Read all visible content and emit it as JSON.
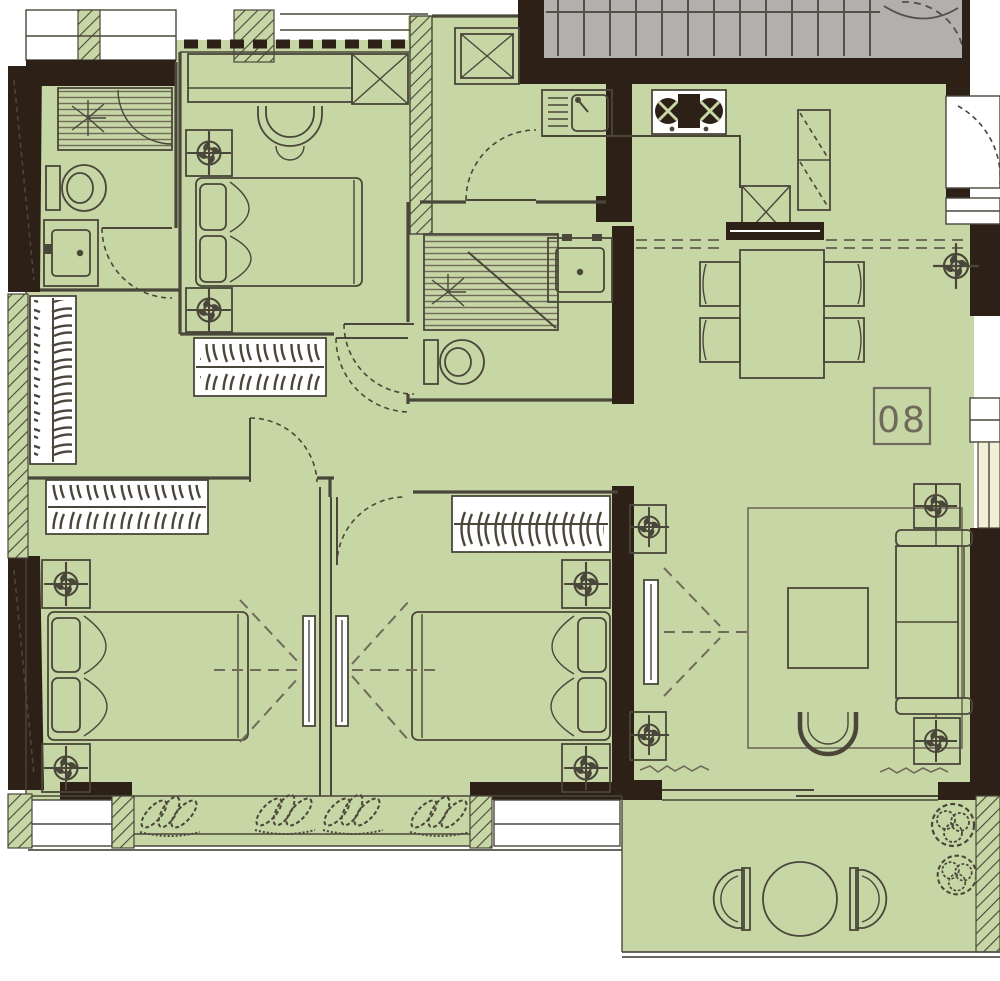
{
  "title": "apartment-unit-floor-plan",
  "unit": {
    "label": "08"
  },
  "colors": {
    "paper": "#ffffff",
    "floor": "#c7d6a5",
    "wall": "#2d2117",
    "ink": "#4a463a",
    "ink_soft": "#6f6a59",
    "gray": "#b2b0ac",
    "gray_line": "#55504a",
    "pale": "#f2efd8"
  },
  "rooms": [
    {
      "name": "stairwell",
      "items": [
        "stairs",
        "landing-door-swing"
      ]
    },
    {
      "name": "entry-hall",
      "items": [
        "entry-door",
        "storage-cabinet"
      ]
    },
    {
      "name": "bathroom-1",
      "items": [
        "shower",
        "toilet",
        "vanity-sink",
        "door"
      ]
    },
    {
      "name": "bedroom-1",
      "items": [
        "desk",
        "desk-chair",
        "storage-cabinet",
        "double-bed",
        "nightstand",
        "nightstand",
        "bedside-lamp",
        "wardrobe"
      ]
    },
    {
      "name": "bathroom-2",
      "items": [
        "shower",
        "toilet",
        "vanity-sink",
        "door"
      ]
    },
    {
      "name": "kitchen",
      "items": [
        "sink-unit",
        "cooktop",
        "refrigerator",
        "service-shaft"
      ]
    },
    {
      "name": "dining-area",
      "items": [
        "dining-table",
        "dining-chair",
        "dining-chair",
        "dining-chair",
        "dining-chair",
        "sideboard",
        "ceiling-lamp",
        "unit-number-plate"
      ]
    },
    {
      "name": "living-room",
      "items": [
        "tv-cabinet",
        "rug",
        "coffee-table",
        "armchair",
        "sofa",
        "side-table",
        "side-table",
        "lamp",
        "lamp"
      ]
    },
    {
      "name": "hallway",
      "items": [
        "coat-closet",
        "linen-closet"
      ]
    },
    {
      "name": "bedroom-2",
      "items": [
        "wardrobe",
        "double-bed",
        "nightstand",
        "nightstand",
        "bedside-lamp",
        "tv-panel"
      ]
    },
    {
      "name": "bedroom-3",
      "items": [
        "wardrobe",
        "double-bed",
        "nightstand",
        "nightstand",
        "bedside-lamp",
        "tv-panel",
        "door"
      ]
    },
    {
      "name": "balcony",
      "items": [
        "round-table",
        "balcony-chair",
        "balcony-chair",
        "potted-plant",
        "potted-plant",
        "sliding-door"
      ]
    },
    {
      "name": "bay-windows",
      "items": [
        "window-plants",
        "window-sill"
      ]
    }
  ]
}
